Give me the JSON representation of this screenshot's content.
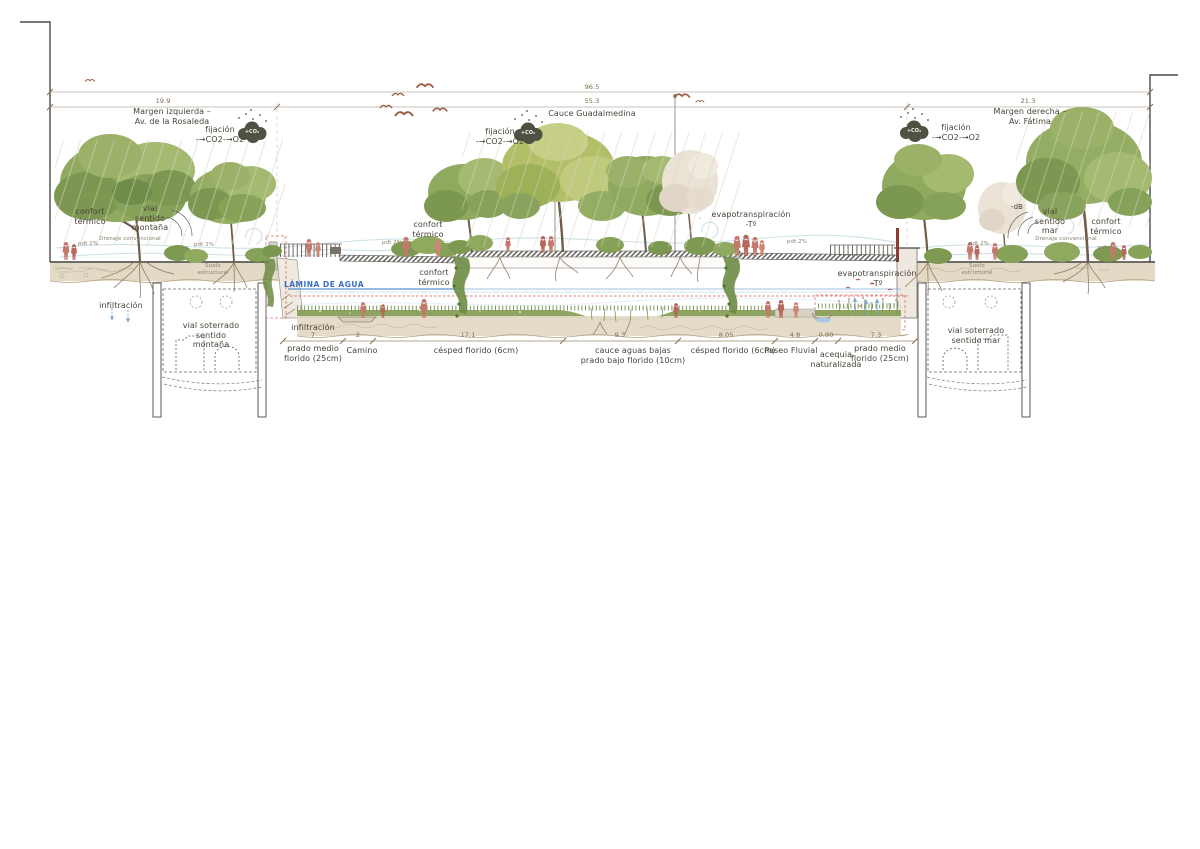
{
  "drawing": {
    "type": "architectural-section",
    "subject": "Cauce Guadalmedina",
    "left_bank": "Margen izquierda – Av. de la Rosaleda",
    "right_bank": "Margen derecha – Av. Fátima",
    "total_width": "96.5",
    "top_segments": [
      "19.9",
      "55.3",
      "21.3"
    ],
    "bottom_segments": [
      "7",
      "2",
      "17.1",
      "9.3",
      "8.05",
      "4.8",
      "0.90",
      "7.3"
    ]
  },
  "palette": {
    "people_red": "#c4796b",
    "water_blue": "#3a6fc4",
    "flood_line_red": "#d65447",
    "soil_tan": "#e3dac6",
    "leaf_green": "#8fa95e",
    "cloud_olive": "#4d5243",
    "text_dark": "#4a4238"
  },
  "icons": {
    "co2_cloud": "co2-cloud-icon",
    "bird": "bird-icon",
    "person": "person-icon",
    "tree": "tree-icon"
  },
  "annotations": [
    {
      "name": "dim-total",
      "cls": "dim",
      "x": 592,
      "y": 84,
      "text": "96.5"
    },
    {
      "name": "dim-margen-izquierda",
      "cls": "dim",
      "x": 163,
      "y": 98,
      "text": "19.9"
    },
    {
      "name": "dim-cauce",
      "cls": "dim",
      "x": 592,
      "y": 98,
      "text": "55.3"
    },
    {
      "name": "dim-margen-derecha",
      "cls": "dim",
      "x": 1028,
      "y": 98,
      "text": "21.3"
    },
    {
      "name": "label-cauce-guadalmedina",
      "cls": "lbl",
      "x": 592,
      "y": 109,
      "text": "Cauce Guadalmedina"
    },
    {
      "name": "label-margen-izquierda",
      "cls": "lbl",
      "x": 172,
      "y": 107,
      "text": "Margen izquierda –\nAv. de la Rosaleda"
    },
    {
      "name": "label-margen-derecha",
      "cls": "lbl",
      "x": 1030,
      "y": 107,
      "text": "Margen derecha –\nAv. Fátima"
    },
    {
      "name": "label-fijacion-left",
      "cls": "lbl",
      "x": 220,
      "y": 125,
      "text": "fijación\n-→CO2-→O2"
    },
    {
      "name": "label-fijacion-center",
      "cls": "lbl",
      "x": 500,
      "y": 127,
      "text": "fijación\n-→CO2-→O2"
    },
    {
      "name": "label-fijacion-right",
      "cls": "lbl",
      "x": 956,
      "y": 123,
      "text": "fijación\n-→CO2-→O2"
    },
    {
      "name": "co2-cloud-text-left",
      "cls": "co2",
      "x": 252,
      "y": 129,
      "text": "+CO₂"
    },
    {
      "name": "co2-cloud-text-center",
      "cls": "co2",
      "x": 528,
      "y": 130,
      "text": "+CO₂"
    },
    {
      "name": "co2-cloud-text-right",
      "cls": "co2",
      "x": 914,
      "y": 128,
      "text": "+CO₂"
    },
    {
      "name": "label-confort-termico-left",
      "cls": "lbl",
      "x": 90,
      "y": 207,
      "text": "confort\ntérmico"
    },
    {
      "name": "label-vial-sentido-montana",
      "cls": "lbl",
      "x": 150,
      "y": 204,
      "text": "vial\nsentido\nmontaña"
    },
    {
      "name": "label-confort-termico-center-upper",
      "cls": "lbl",
      "x": 428,
      "y": 220,
      "text": "confort\ntérmico"
    },
    {
      "name": "label-confort-termico-center-lower",
      "cls": "lbl",
      "x": 434,
      "y": 268,
      "text": "confort\ntérmico"
    },
    {
      "name": "label-evapotranspiracion-center",
      "cls": "lbl",
      "x": 751,
      "y": 210,
      "text": "evapotranspiración\n-Tº"
    },
    {
      "name": "label-evapotranspiracion-right",
      "cls": "lbl",
      "x": 877,
      "y": 269,
      "text": "evapotranspiración\n-Tº"
    },
    {
      "name": "label-vial-sentido-mar",
      "cls": "lbl",
      "x": 1050,
      "y": 207,
      "text": "vial\nsentido\nmar"
    },
    {
      "name": "label-confort-termico-right",
      "cls": "lbl",
      "x": 1106,
      "y": 217,
      "text": "confort\ntérmico"
    },
    {
      "name": "label-db-right",
      "cls": "sm",
      "x": 1017,
      "y": 203,
      "text": "-dB"
    },
    {
      "name": "label-lamina-de-agua",
      "cls": "blue",
      "x": 324,
      "y": 280,
      "text": "LÁMINA DE AGUA"
    },
    {
      "name": "label-infiltracion-left",
      "cls": "lbl",
      "x": 121,
      "y": 301,
      "text": "infiltración"
    },
    {
      "name": "label-infiltracion-center",
      "cls": "lbl",
      "x": 313,
      "y": 323,
      "text": "infiltración"
    },
    {
      "name": "label-suelo-estructural-left",
      "cls": "tiny",
      "x": 213,
      "y": 263,
      "text": "Suelo\nestructural"
    },
    {
      "name": "label-suelo-estructural-right",
      "cls": "tiny",
      "x": 977,
      "y": 263,
      "text": "Suelo\nestructural"
    },
    {
      "name": "label-drenaje-left",
      "cls": "tiny",
      "x": 130,
      "y": 236,
      "text": "Drenaje convencional"
    },
    {
      "name": "label-drenaje-right",
      "cls": "tiny",
      "x": 1066,
      "y": 236,
      "text": "Drenaje convencional"
    },
    {
      "name": "label-pdt-1",
      "cls": "tiny",
      "x": 88,
      "y": 241,
      "text": "pdt 2%"
    },
    {
      "name": "label-pdt-2",
      "cls": "tiny",
      "x": 204,
      "y": 242,
      "text": "pdt 2%"
    },
    {
      "name": "label-pdt-3",
      "cls": "tiny",
      "x": 392,
      "y": 240,
      "text": "pdt 2%"
    },
    {
      "name": "label-pdt-4",
      "cls": "tiny",
      "x": 797,
      "y": 239,
      "text": "pdt 2%"
    },
    {
      "name": "label-pdt-5",
      "cls": "tiny",
      "x": 979,
      "y": 241,
      "text": "pdt 2%"
    },
    {
      "name": "label-pdt-6",
      "cls": "tiny",
      "x": 1108,
      "y": 245,
      "text": "pdt 2%"
    },
    {
      "name": "label-vial-soterrado-montana",
      "cls": "lbl",
      "x": 211,
      "y": 321,
      "text": "vial soterrado\nsentido\nmontaña"
    },
    {
      "name": "label-vial-soterrado-mar",
      "cls": "lbl",
      "x": 976,
      "y": 326,
      "text": "vial soterrado\nsentido mar"
    },
    {
      "name": "dim-prado-left",
      "cls": "dim",
      "x": 313,
      "y": 332,
      "text": "7"
    },
    {
      "name": "dim-camino",
      "cls": "dim",
      "x": 358,
      "y": 332,
      "text": "2"
    },
    {
      "name": "dim-cesped-left",
      "cls": "dim",
      "x": 468,
      "y": 332,
      "text": "17.1"
    },
    {
      "name": "dim-cauce-bajas",
      "cls": "dim",
      "x": 620,
      "y": 332,
      "text": "9.3"
    },
    {
      "name": "dim-cesped-right",
      "cls": "dim",
      "x": 726,
      "y": 332,
      "text": "8.05"
    },
    {
      "name": "dim-paseo",
      "cls": "dim",
      "x": 795,
      "y": 332,
      "text": "4.8"
    },
    {
      "name": "dim-acequia",
      "cls": "dim",
      "x": 826,
      "y": 332,
      "text": "0.90"
    },
    {
      "name": "dim-prado-right",
      "cls": "dim",
      "x": 876,
      "y": 332,
      "text": "7.3"
    },
    {
      "name": "label-prado-left",
      "cls": "lbl",
      "x": 313,
      "y": 344,
      "text": "prado medio\nflorido (25cm)"
    },
    {
      "name": "label-camino",
      "cls": "lbl",
      "x": 362,
      "y": 346,
      "text": "Camino"
    },
    {
      "name": "label-cesped-left",
      "cls": "lbl",
      "x": 476,
      "y": 346,
      "text": "césped florido (6cm)"
    },
    {
      "name": "label-cauce-aguas-bajas",
      "cls": "lbl",
      "x": 633,
      "y": 346,
      "text": "cauce aguas bajas\nprado bajo florido (10cm)"
    },
    {
      "name": "label-cesped-right",
      "cls": "lbl",
      "x": 733,
      "y": 346,
      "text": "césped florido (6cm)"
    },
    {
      "name": "label-paseo-fluvial",
      "cls": "lbl",
      "x": 791,
      "y": 346,
      "text": "Paseo Fluvial"
    },
    {
      "name": "label-acequia",
      "cls": "lbl",
      "x": 836,
      "y": 350,
      "text": "acequia\nnaturalizada"
    },
    {
      "name": "label-prado-right",
      "cls": "lbl",
      "x": 880,
      "y": 344,
      "text": "prado medio\nflorido (25cm)"
    }
  ]
}
